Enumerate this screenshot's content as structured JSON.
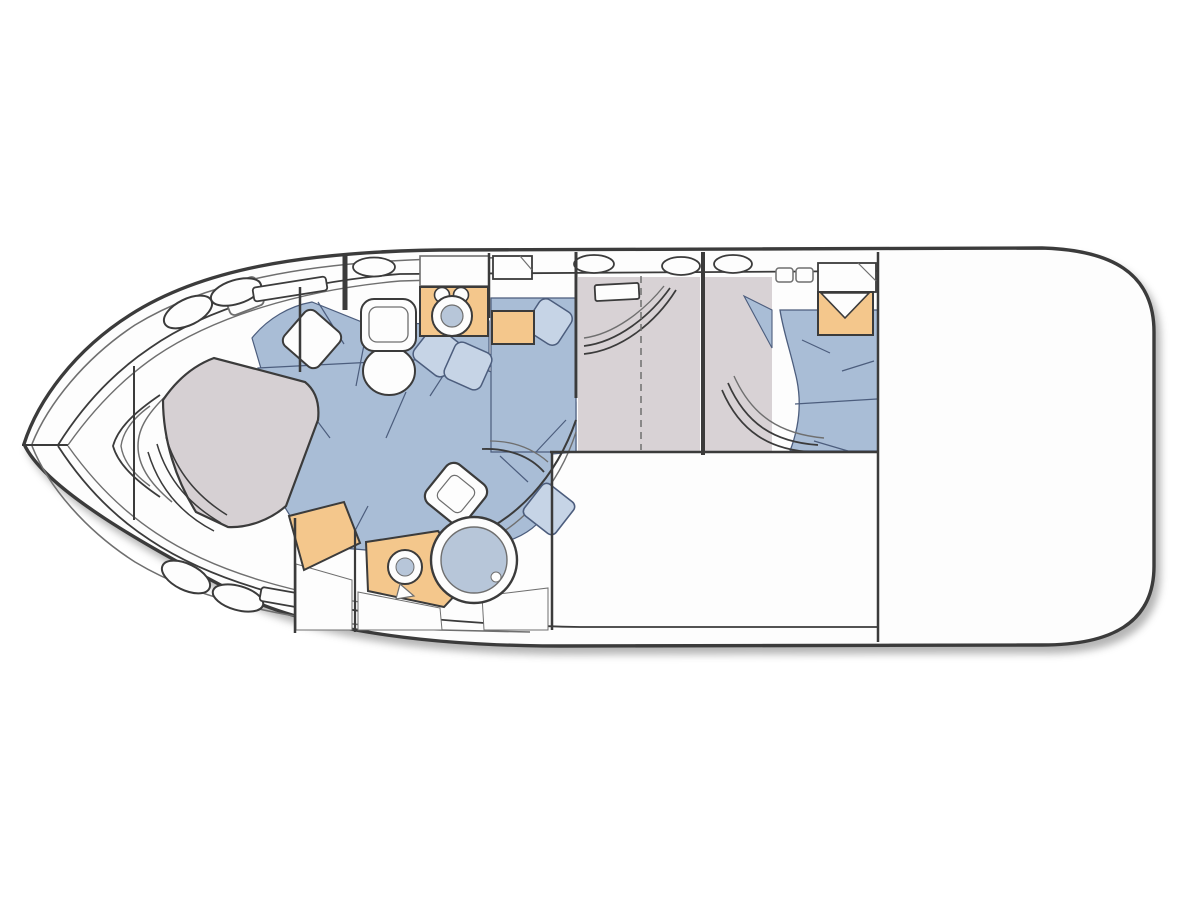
{
  "figure": {
    "kind": "yacht-interior-deck-plan",
    "bow_side": "left",
    "stern_side": "right"
  },
  "palette": {
    "outline_dark": "#3b3b3b",
    "outline_soft": "#6f6f6f",
    "seam_blue": "#4c5d7d",
    "hull_white": "#fdfdfd",
    "upholstery_blue": "#a9bdd6",
    "pillow_blue": "#c6d4e6",
    "floor_gray": "#d8d2d5",
    "bed_gray": "#d6d0d3",
    "cabinet_orange": "#f4c78c",
    "basin_blue": "#b7c6d9",
    "fixture_white": "#fdfdfd"
  },
  "compartments": [
    {
      "name": "forward stateroom with island v-berth",
      "features": [
        "island-berth",
        "settee",
        "seat-cushion",
        "portholes",
        "hull-windows"
      ]
    },
    {
      "name": "forward head",
      "features": [
        "toilet",
        "vanity-counter",
        "round-sink",
        "faucet"
      ]
    },
    {
      "name": "amidships lockers",
      "features": [
        "locker",
        "cabinet",
        "berth-pillow"
      ]
    },
    {
      "name": "salon dinette seating",
      "features": [
        "u-shaped-settee",
        "pillows",
        "curved-seat-back"
      ]
    },
    {
      "name": "midship cabin",
      "features": [
        "door",
        "window",
        "gray-sole"
      ]
    },
    {
      "name": "aft stateroom",
      "features": [
        "double-berth",
        "nightstand",
        "locker",
        "door",
        "hatches"
      ]
    },
    {
      "name": "lower head with shower",
      "features": [
        "vanity-counter",
        "round-sink",
        "toilet",
        "round-shower-stall",
        "floorboards"
      ]
    },
    {
      "name": "aft cockpit deck",
      "features": [
        "open-deck"
      ]
    }
  ]
}
